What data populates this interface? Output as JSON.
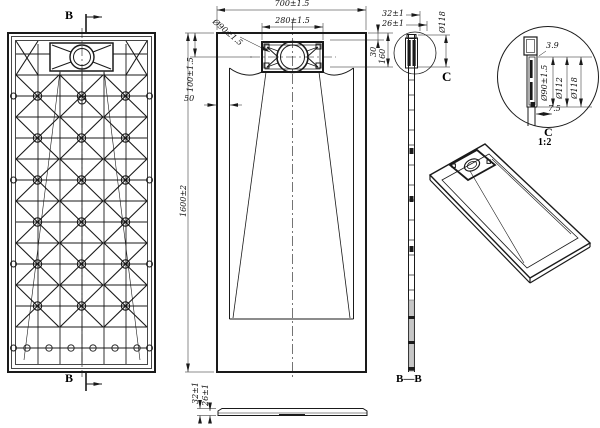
{
  "labels": {
    "section_b": "B",
    "section_bb": "B—B",
    "detail_c": "C",
    "detail_scale": "1:2"
  },
  "top_view": {
    "width": "700±1.5",
    "drain_width": "280±1.5",
    "drain_diameter": "Ø90±1.5",
    "drain_offset": "100±1.5",
    "edge_offset": "50",
    "length": "1600±2",
    "recess_start": "30",
    "recess_end": "160"
  },
  "section_bb": {
    "height_total": "32±1",
    "height_base": "26±1",
    "flange_diameter": "Ø118"
  },
  "detail_c": {
    "lip_thickness": "3.9",
    "drain_diameter": "Ø90±1.5",
    "ring_diameter": "Ø112",
    "flange_diameter": "Ø118",
    "edge_width": "7.5"
  },
  "profile_view": {
    "height_total": "32±1",
    "height_base": "26±1"
  },
  "style": {
    "line_color": "#1a1a1a",
    "hatch_color": "#c6c6c6",
    "background": "#ffffff"
  }
}
